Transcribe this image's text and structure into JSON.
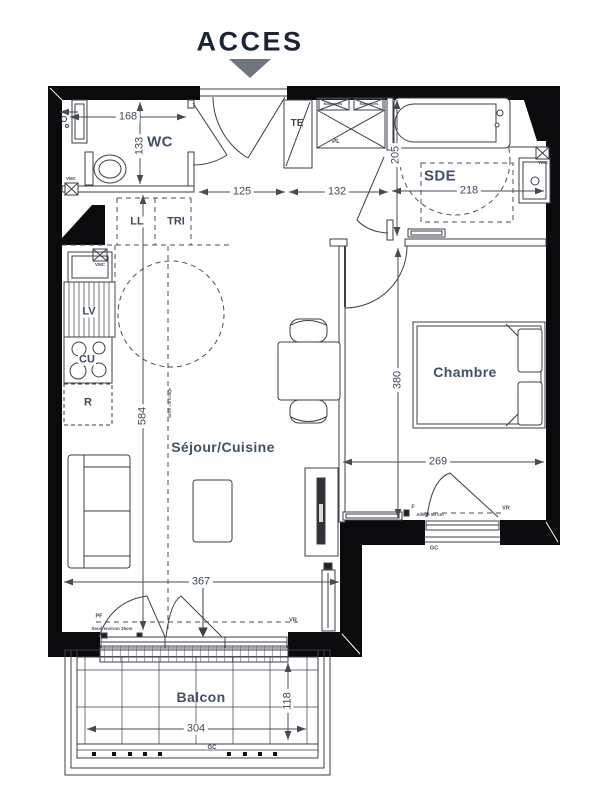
{
  "header": {
    "access": "ACCES"
  },
  "rooms": {
    "wc": "WC",
    "sde": "SDE",
    "chambre": "Chambre",
    "sejour": "Séjour/Cuisine",
    "balcon": "Balcon"
  },
  "equipment": {
    "te": "TE",
    "pl": "PL",
    "nourrices_left": "Nourrices",
    "nourrices_right": "Nourrices",
    "ll": "LL",
    "tri": "TRI",
    "lv": "LV",
    "cu": "CU",
    "r": "R",
    "vmc_wc": "VMC",
    "vmc_kitchen": "VMC",
    "vmc_sde": "VMC"
  },
  "openings": {
    "f_chambre": "F",
    "allege": "Allège 50 cm",
    "vr_chambre": "VR",
    "gc_chambre": "GC",
    "pf": "PF",
    "seuil": "Seuil environ 15cm",
    "vr_sejour": "VR",
    "gc_balcon": "GC"
  },
  "notes": {
    "limite_carrelage": "limite carrelage"
  },
  "dimensions": {
    "d168": "168",
    "d133": "133",
    "d125": "125",
    "d132": "132",
    "d205": "205",
    "d218": "218",
    "d584": "584",
    "d380": "380",
    "d269": "269",
    "d367": "367",
    "d304": "304",
    "d118": "118"
  },
  "colors": {
    "wall": "#0b0b0d",
    "line": "#3b3f46",
    "text": "#3f4a5e",
    "arrow_fill": "#6e757d"
  }
}
